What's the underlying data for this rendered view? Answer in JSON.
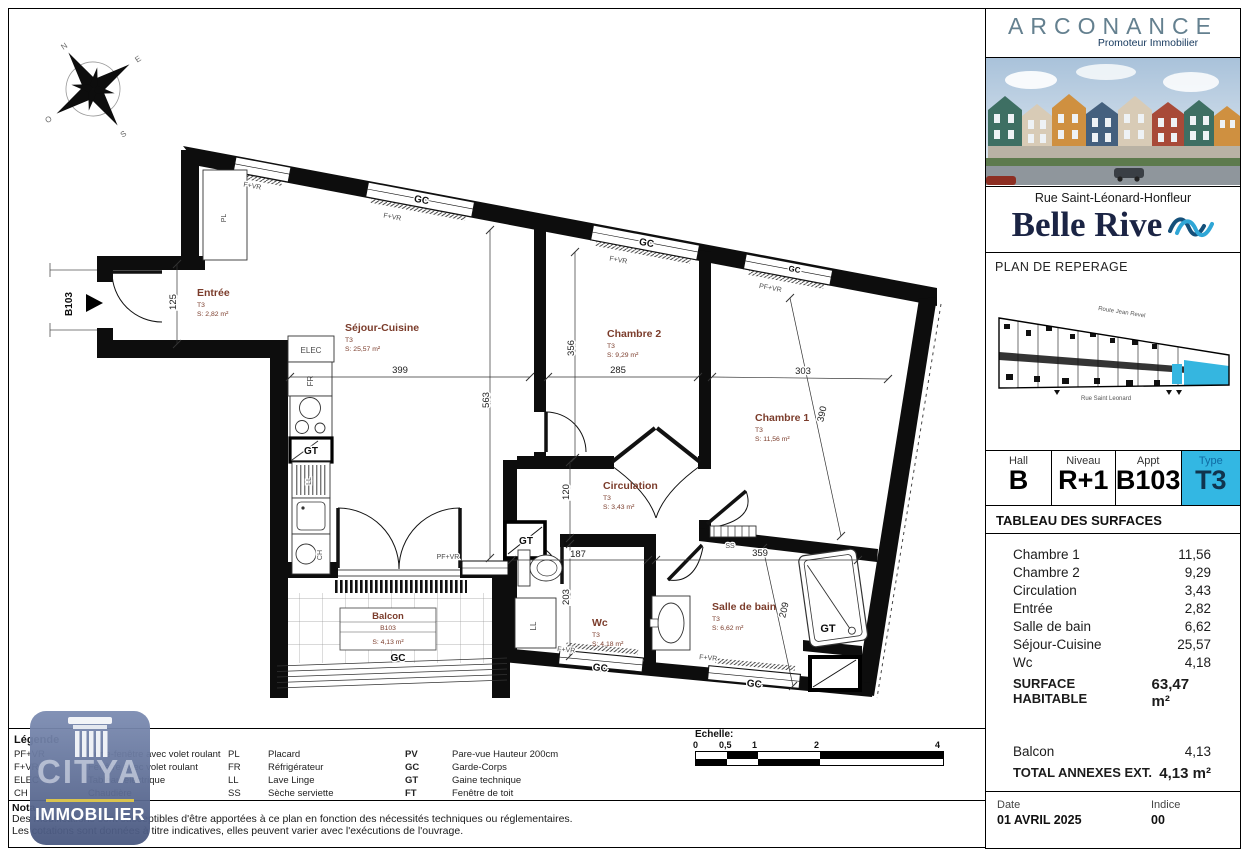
{
  "sidebar": {
    "brand": {
      "name": "ARCONANCE",
      "tagline": "Promoteur Immobilier"
    },
    "address": "Rue Saint-Léonard-Honfleur",
    "project": "Belle Rive",
    "reperage_title": "PLAN DE REPERAGE",
    "site_plan": {
      "street_top": "Route Jean Revel",
      "street_bottom": "Rue Saint Leonard"
    },
    "unit_table": {
      "hall_label": "Hall",
      "hall_value": "B",
      "niveau_label": "Niveau",
      "niveau_value": "R+1",
      "appt_label": "Appt",
      "appt_value": "B103",
      "type_label": "Type",
      "type_value": "T3"
    },
    "surfaces": {
      "title": "TABLEAU DES SURFACES",
      "rows": [
        {
          "label": "Chambre 1",
          "value": "11,56"
        },
        {
          "label": "Chambre 2",
          "value": "9,29"
        },
        {
          "label": "Circulation",
          "value": "3,43"
        },
        {
          "label": "Entrée",
          "value": "2,82"
        },
        {
          "label": "Salle de bain",
          "value": "6,62"
        },
        {
          "label": "Séjour-Cuisine",
          "value": "25,57"
        },
        {
          "label": "Wc",
          "value": "4,18"
        }
      ],
      "total_label": "SURFACE HABITABLE",
      "total_value": "63,47 m²",
      "annex_rows": [
        {
          "label": "Balcon",
          "value": "4,13"
        }
      ],
      "annex_total_label": "TOTAL ANNEXES EXT.",
      "annex_total_value": "4,13 m²"
    },
    "footer": {
      "date_label": "Date",
      "date_value": "01 AVRIL 2025",
      "indice_label": "Indice",
      "indice_value": "00"
    }
  },
  "plan": {
    "rooms": {
      "entree": {
        "name": "Entrée",
        "type": "T3",
        "area": "S: 2,82 m²"
      },
      "sejour": {
        "name": "Séjour-Cuisine",
        "type": "T3",
        "area": "S: 25,57 m²"
      },
      "chambre2": {
        "name": "Chambre 2",
        "type": "T3",
        "area": "S: 9,29 m²"
      },
      "chambre1": {
        "name": "Chambre 1",
        "type": "T3",
        "area": "S: 11,56 m²"
      },
      "circulation": {
        "name": "Circulation",
        "type": "T3",
        "area": "S: 3,43 m²"
      },
      "wc": {
        "name": "Wc",
        "type": "T3",
        "area": "S: 4,18 m²"
      },
      "sdb": {
        "name": "Salle de bain",
        "type": "T3",
        "area": "S: 6,62 m²"
      }
    },
    "balcony": {
      "name": "Balcon",
      "code": "B103",
      "area": "S: 4,13 m²"
    },
    "dims": {
      "d399": "399",
      "d285": "285",
      "d303": "303",
      "d563": "563",
      "d356": "356",
      "d120": "120",
      "d203": "203",
      "d187": "187",
      "d359": "359",
      "d125": "125",
      "d390": "390",
      "d209": "209"
    },
    "labels": {
      "gc": "GC",
      "fvr": "F+VR",
      "pfvr": "PF+VR",
      "gt": "GT",
      "elec": "ELEC",
      "fr": "FR",
      "ll": "LL",
      "ch": "CH",
      "ss": "SS",
      "pl": "PL",
      "door": "B103"
    },
    "compass": {
      "n": "N",
      "e": "E",
      "s": "S",
      "o": "O"
    }
  },
  "legend": {
    "title": "Légende",
    "col1": [
      {
        "abbr": "PF+VR",
        "def": "Porte-fenêtre avec volet roulant"
      },
      {
        "abbr": "F+VR",
        "def": "Fenêtre avec volet roulant"
      },
      {
        "abbr": "ELEC",
        "def": "Tableau électrique"
      },
      {
        "abbr": "CH",
        "def": "Chaudière"
      }
    ],
    "col2": [
      {
        "abbr": "PL",
        "def": "Placard"
      },
      {
        "abbr": "FR",
        "def": "Réfrigérateur"
      },
      {
        "abbr": "LL",
        "def": "Lave Linge"
      },
      {
        "abbr": "SS",
        "def": "Sèche serviette"
      }
    ],
    "col3": [
      {
        "abbr": "PV",
        "def": "Pare-vue Hauteur 200cm"
      },
      {
        "abbr": "GC",
        "def": "Garde-Corps"
      },
      {
        "abbr": "GT",
        "def": "Gaine technique"
      },
      {
        "abbr": "FT",
        "def": "Fenêtre de toit"
      }
    ]
  },
  "nota": {
    "title": "Nota",
    "line1": "Des modifications sont susceptibles d'être apportées à ce plan en fonction des nécessités techniques ou réglementaires.",
    "line2": "Les cotations sont données à titre indicatives, elles peuvent varier avec l'exécutions de l'ouvrage."
  },
  "scale": {
    "title": "Echelle:",
    "t0": "0",
    "t05": "0,5",
    "t1": "1",
    "t2": "2",
    "t4": "4"
  },
  "watermark": {
    "name": "CITYA",
    "subtitle": "IMMOBILIER"
  },
  "colors": {
    "accent": "#33b7e3",
    "room_label": "#7b3c2b"
  }
}
